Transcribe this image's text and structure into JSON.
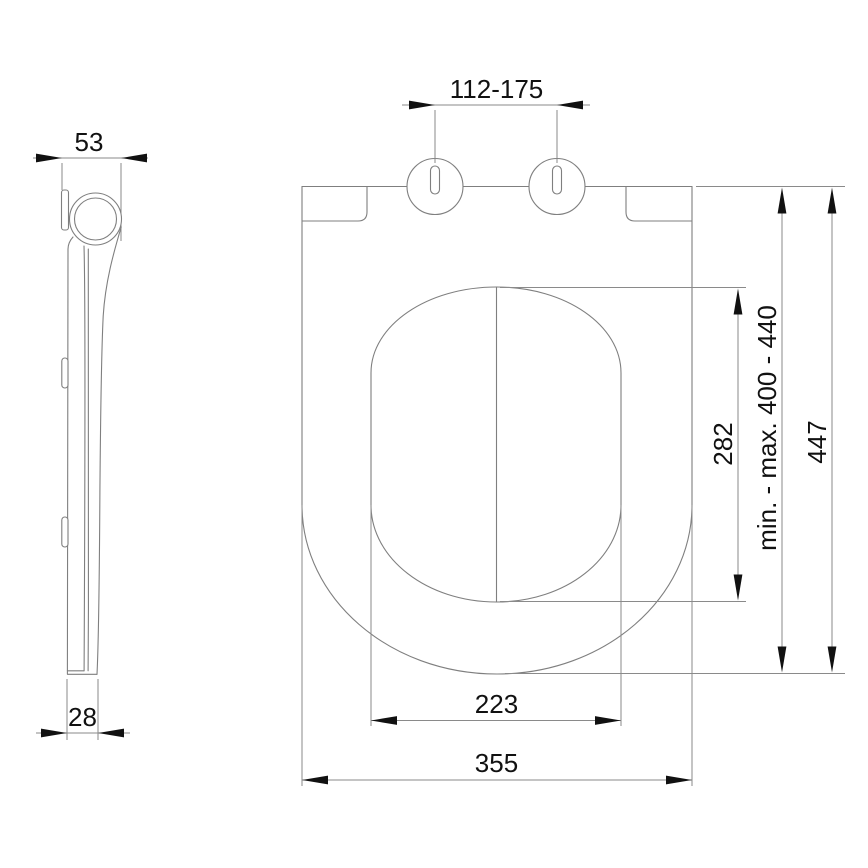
{
  "colors": {
    "background": "#ffffff",
    "linework": "#7f7f7f",
    "dimension_ink": "#111111"
  },
  "dimensions": {
    "side_view": {
      "top_depth": "53",
      "bottom_depth": "28"
    },
    "top_view": {
      "hinge_spacing": "112-175",
      "opening_length": "282",
      "mounting_range": "min. - max. 400 - 440",
      "overall_length": "447",
      "opening_width": "223",
      "overall_width": "355"
    }
  }
}
